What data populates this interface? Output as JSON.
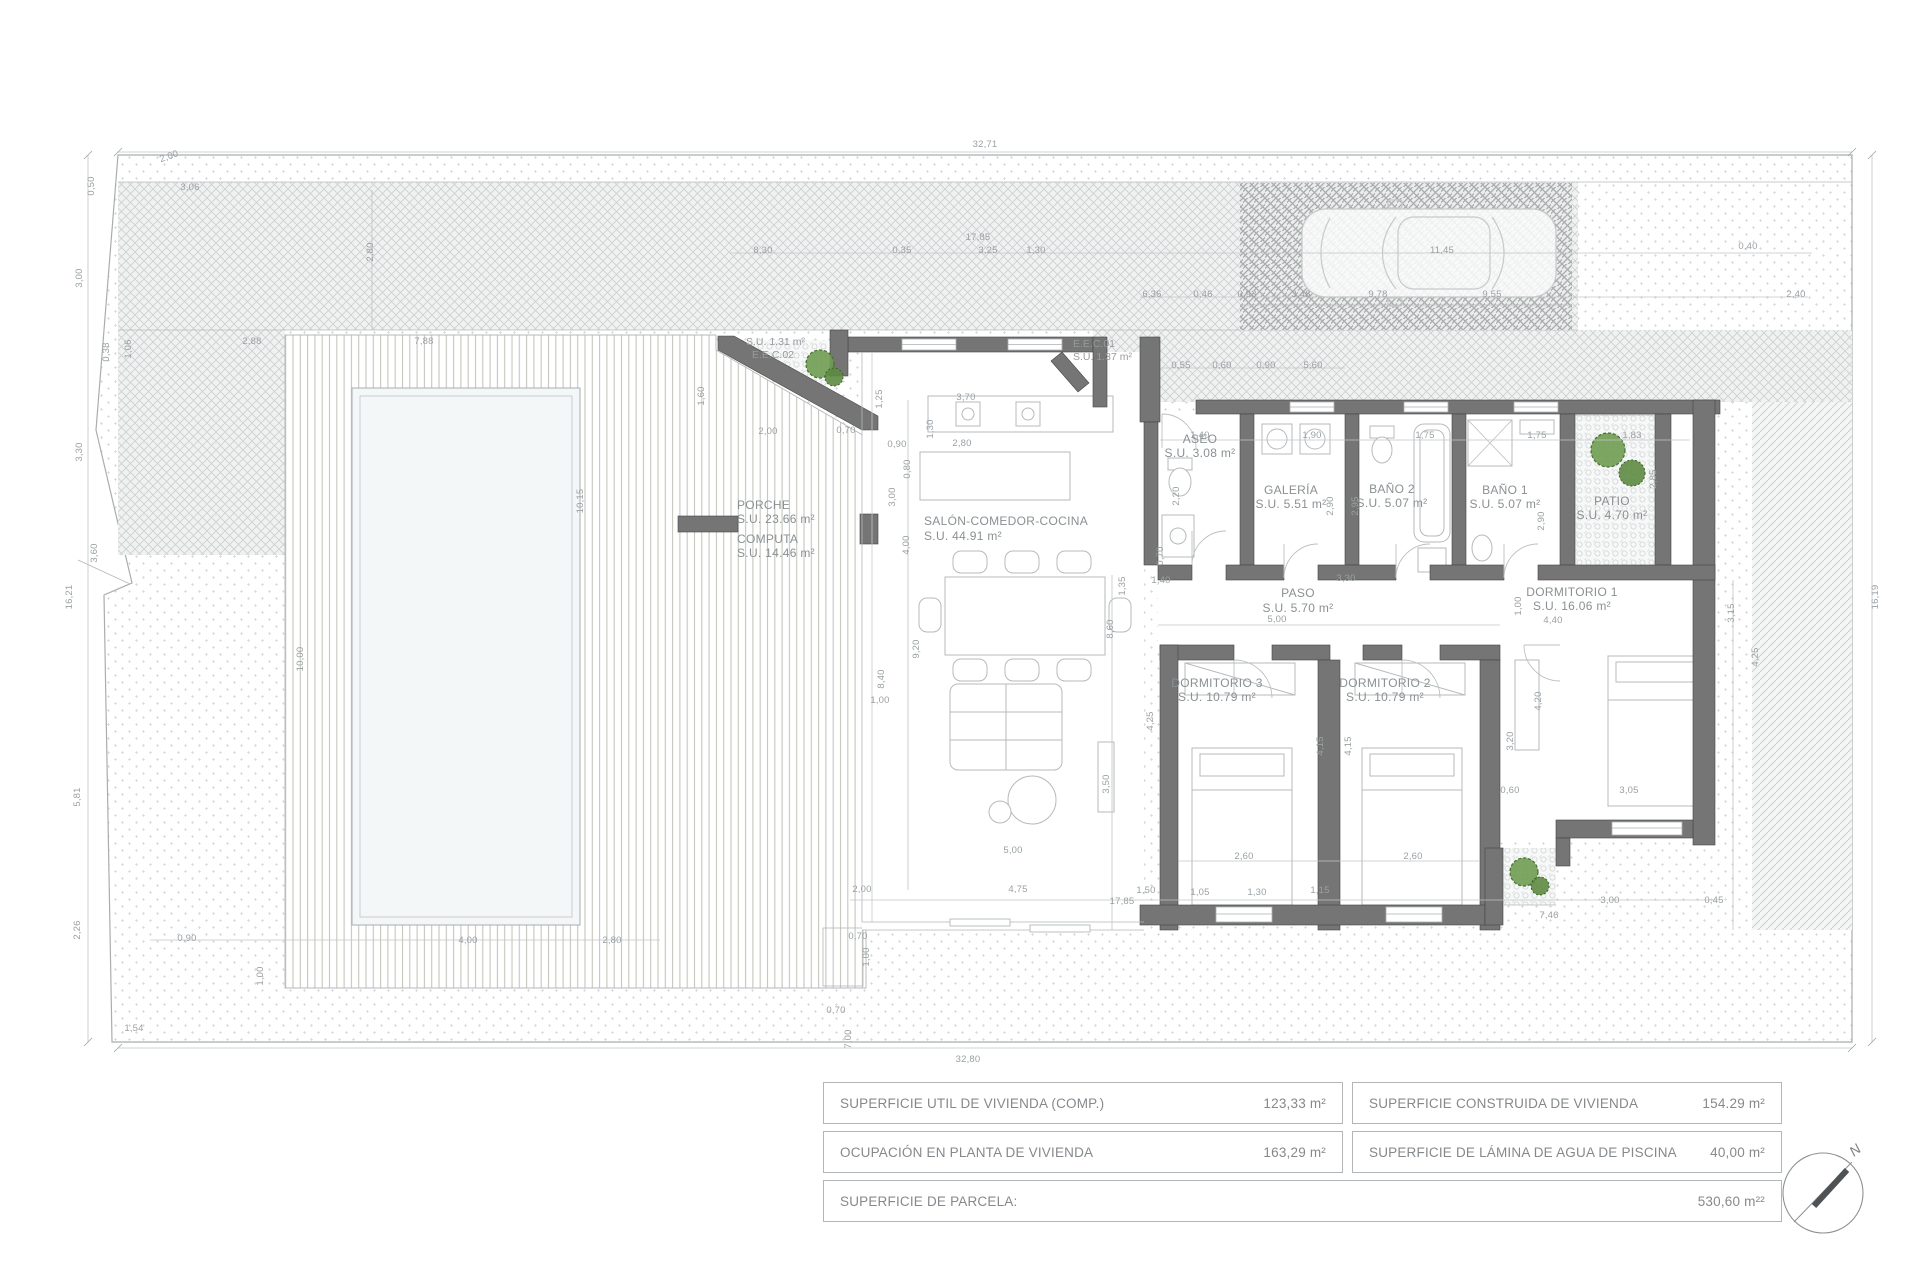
{
  "rooms": {
    "porche": {
      "name": "PORCHE",
      "area": "S.U. 23.66 m²"
    },
    "computa": {
      "name": "COMPUTA",
      "area": "S.U. 14.46 m²"
    },
    "salon": {
      "name": "SALÓN-COMEDOR-COCINA",
      "area": "S.U. 44.91 m²"
    },
    "aseo": {
      "name": "ASEO",
      "area": "S.U. 3.08 m²"
    },
    "galeria": {
      "name": "GALERÍA",
      "area": "S.U. 5.51 m²"
    },
    "bano2": {
      "name": "BAÑO 2",
      "area": "S.U. 5.07 m²"
    },
    "bano1": {
      "name": "BAÑO 1",
      "area": "S.U. 5.07 m²"
    },
    "patio": {
      "name": "PATIO",
      "area": "S.U. 4.70 m²"
    },
    "paso": {
      "name": "PASO",
      "area": "S.U. 5.70 m²"
    },
    "dorm1": {
      "name": "DORMITORIO 1",
      "area": "S.U. 16.06 m²"
    },
    "dorm2": {
      "name": "DORMITORIO 2",
      "area": "S.U. 10.79 m²"
    },
    "dorm3": {
      "name": "DORMITORIO 3",
      "area": "S.U. 10.79 m²"
    },
    "eec01": {
      "name": "E.E.C.01",
      "area": "S.U. 1.37 m²"
    },
    "eec02": {
      "name": "E.E.C.02",
      "area": "S.U. 1.31 m²"
    }
  },
  "summary": {
    "rows": [
      {
        "label": "SUPERFICIE UTIL  DE VIVIENDA (COMP.)",
        "value": "123,33  m²"
      },
      {
        "label": "SUPERFICIE CONSTRUIDA DE VIVIENDA",
        "value": "154.29  m²"
      },
      {
        "label": "OCUPACIÓN EN PLANTA DE VIVIENDA",
        "value": "163,29 m²"
      },
      {
        "label": "SUPERFICIE DE LÁMINA DE AGUA DE PISCINA",
        "value": "40,00  m²"
      },
      {
        "label": "SUPERFICIE DE PARCELA:",
        "value": "530,60 m²²"
      }
    ]
  },
  "compass": {
    "north_label": "N"
  },
  "colors": {
    "wall": "#757575",
    "plant": "#6f9c52",
    "dim_text": "#9aa0a3",
    "label_text": "#8a9092"
  },
  "dimensions": [
    {
      "t": "32,71",
      "x": 985,
      "y": 147,
      "r": 0
    },
    {
      "t": "32,80",
      "x": 968,
      "y": 1062,
      "r": 0
    },
    {
      "t": "16,21",
      "x": 72,
      "y": 597,
      "r": -90
    },
    {
      "t": "16,19",
      "x": 1878,
      "y": 597,
      "r": -90
    },
    {
      "t": "2,00",
      "x": 170,
      "y": 159,
      "r": -20
    },
    {
      "t": "0,50",
      "x": 94,
      "y": 186,
      "r": -90
    },
    {
      "t": "3,00",
      "x": 82,
      "y": 278,
      "r": -90
    },
    {
      "t": "3,30",
      "x": 82,
      "y": 452,
      "r": -90
    },
    {
      "t": "3,60",
      "x": 97,
      "y": 553,
      "r": -90
    },
    {
      "t": "5,81",
      "x": 80,
      "y": 797,
      "r": -90
    },
    {
      "t": "2,26",
      "x": 80,
      "y": 930,
      "r": -90
    },
    {
      "t": "1,54",
      "x": 134,
      "y": 1031,
      "r": 0
    },
    {
      "t": "0,38",
      "x": 109,
      "y": 352,
      "r": -90
    },
    {
      "t": "1,06",
      "x": 131,
      "y": 349,
      "r": -90
    },
    {
      "t": "2,88",
      "x": 252,
      "y": 344,
      "r": 0
    },
    {
      "t": "7,88",
      "x": 424,
      "y": 344,
      "r": 0
    },
    {
      "t": "3,06",
      "x": 190,
      "y": 190,
      "r": 0
    },
    {
      "t": "2,80",
      "x": 373,
      "y": 252,
      "r": -90
    },
    {
      "t": "17,85",
      "x": 978,
      "y": 240,
      "r": 0
    },
    {
      "t": "8,30",
      "x": 763,
      "y": 253,
      "r": 0
    },
    {
      "t": "0,35",
      "x": 902,
      "y": 253,
      "r": 0
    },
    {
      "t": "3,25",
      "x": 988,
      "y": 253,
      "r": 0
    },
    {
      "t": "1,30",
      "x": 1036,
      "y": 253,
      "r": 0
    },
    {
      "t": "11,45",
      "x": 1442,
      "y": 253,
      "r": 0
    },
    {
      "t": "0,40",
      "x": 1748,
      "y": 249,
      "r": 0
    },
    {
      "t": "6,36",
      "x": 1152,
      "y": 297,
      "r": 0
    },
    {
      "t": "0,46",
      "x": 1203,
      "y": 297,
      "r": 0
    },
    {
      "t": "0,93",
      "x": 1247,
      "y": 297,
      "r": 0
    },
    {
      "t": "3,48",
      "x": 1301,
      "y": 297,
      "r": 0
    },
    {
      "t": "9,78",
      "x": 1378,
      "y": 297,
      "r": 0
    },
    {
      "t": "9,55",
      "x": 1492,
      "y": 297,
      "r": 0
    },
    {
      "t": "2,40",
      "x": 1796,
      "y": 297,
      "r": 0
    },
    {
      "t": "0,55",
      "x": 1181,
      "y": 368,
      "r": 0
    },
    {
      "t": "0,60",
      "x": 1222,
      "y": 368,
      "r": 0
    },
    {
      "t": "0,90",
      "x": 1266,
      "y": 368,
      "r": 0
    },
    {
      "t": "5,60",
      "x": 1313,
      "y": 368,
      "r": 0
    },
    {
      "t": "1,60",
      "x": 704,
      "y": 396,
      "r": -90
    },
    {
      "t": "2,00",
      "x": 768,
      "y": 434,
      "r": 0
    },
    {
      "t": "0,70",
      "x": 846,
      "y": 433,
      "r": 0
    },
    {
      "t": "0,90",
      "x": 897,
      "y": 447,
      "r": 0
    },
    {
      "t": "3,70",
      "x": 966,
      "y": 400,
      "r": 0
    },
    {
      "t": "1,25",
      "x": 882,
      "y": 399,
      "r": -90
    },
    {
      "t": "2,80",
      "x": 962,
      "y": 446,
      "r": 0
    },
    {
      "t": "1,30",
      "x": 933,
      "y": 429,
      "r": -90
    },
    {
      "t": "0,80",
      "x": 910,
      "y": 469,
      "r": -90
    },
    {
      "t": "3,00",
      "x": 895,
      "y": 497,
      "r": -90
    },
    {
      "t": "4,00",
      "x": 909,
      "y": 545,
      "r": -90
    },
    {
      "t": "9,20",
      "x": 919,
      "y": 649,
      "r": -90
    },
    {
      "t": "8,40",
      "x": 884,
      "y": 679,
      "r": -90
    },
    {
      "t": "1,00",
      "x": 880,
      "y": 703,
      "r": 0
    },
    {
      "t": "3,50",
      "x": 1109,
      "y": 784,
      "r": -90
    },
    {
      "t": "4,25",
      "x": 1153,
      "y": 721,
      "r": -90
    },
    {
      "t": "5,00",
      "x": 1013,
      "y": 853,
      "r": 0
    },
    {
      "t": "10,15",
      "x": 583,
      "y": 501,
      "r": -90
    },
    {
      "t": "10,00",
      "x": 303,
      "y": 659,
      "r": -90
    },
    {
      "t": "4,00",
      "x": 468,
      "y": 943,
      "r": 0
    },
    {
      "t": "2,80",
      "x": 612,
      "y": 943,
      "r": 0
    },
    {
      "t": "0,90",
      "x": 187,
      "y": 941,
      "r": 0
    },
    {
      "t": "1,00",
      "x": 263,
      "y": 976,
      "r": -90
    },
    {
      "t": "1,40",
      "x": 1200,
      "y": 438,
      "r": 0
    },
    {
      "t": "1,90",
      "x": 1312,
      "y": 438,
      "r": 0
    },
    {
      "t": "1,75",
      "x": 1425,
      "y": 438,
      "r": 0
    },
    {
      "t": "1,75",
      "x": 1537,
      "y": 438,
      "r": 0
    },
    {
      "t": "1,83",
      "x": 1632,
      "y": 438,
      "r": 0
    },
    {
      "t": "2,20",
      "x": 1179,
      "y": 496,
      "r": -90
    },
    {
      "t": "2,90",
      "x": 1333,
      "y": 506,
      "r": -90
    },
    {
      "t": "2,95",
      "x": 1358,
      "y": 506,
      "r": -90
    },
    {
      "t": "2,90",
      "x": 1544,
      "y": 521,
      "r": -90
    },
    {
      "t": "2,85",
      "x": 1656,
      "y": 479,
      "r": -90
    },
    {
      "t": "1,40",
      "x": 1161,
      "y": 583,
      "r": 0
    },
    {
      "t": "3,30",
      "x": 1346,
      "y": 581,
      "r": 0
    },
    {
      "t": "0,70",
      "x": 1163,
      "y": 556,
      "r": -90
    },
    {
      "t": "5,00",
      "x": 1277,
      "y": 622,
      "r": 0
    },
    {
      "t": "1,35",
      "x": 1125,
      "y": 586,
      "r": -90
    },
    {
      "t": "8,60",
      "x": 1113,
      "y": 629,
      "r": -90
    },
    {
      "t": "1,00",
      "x": 1521,
      "y": 606,
      "r": -90
    },
    {
      "t": "4,40",
      "x": 1553,
      "y": 623,
      "r": 0
    },
    {
      "t": "4,20",
      "x": 1541,
      "y": 701,
      "r": -90
    },
    {
      "t": "3,20",
      "x": 1513,
      "y": 741,
      "r": -90
    },
    {
      "t": "4,15",
      "x": 1323,
      "y": 746,
      "r": -90
    },
    {
      "t": "4,15",
      "x": 1351,
      "y": 746,
      "r": -90
    },
    {
      "t": "0,60",
      "x": 1510,
      "y": 793,
      "r": 0
    },
    {
      "t": "3,05",
      "x": 1629,
      "y": 793,
      "r": 0
    },
    {
      "t": "2,60",
      "x": 1244,
      "y": 859,
      "r": 0
    },
    {
      "t": "2,60",
      "x": 1413,
      "y": 859,
      "r": 0
    },
    {
      "t": "2,00",
      "x": 862,
      "y": 892,
      "r": 0
    },
    {
      "t": "4,75",
      "x": 1018,
      "y": 892,
      "r": 0
    },
    {
      "t": "1,50",
      "x": 1146,
      "y": 893,
      "r": 0
    },
    {
      "t": "1,05",
      "x": 1200,
      "y": 895,
      "r": 0
    },
    {
      "t": "1,30",
      "x": 1257,
      "y": 895,
      "r": 0
    },
    {
      "t": "1,15",
      "x": 1320,
      "y": 893,
      "r": 0
    },
    {
      "t": "17,85",
      "x": 1122,
      "y": 904,
      "r": 0
    },
    {
      "t": "3,00",
      "x": 1610,
      "y": 903,
      "r": 0
    },
    {
      "t": "0,45",
      "x": 1714,
      "y": 903,
      "r": 0
    },
    {
      "t": "7,46",
      "x": 1549,
      "y": 918,
      "r": 0
    },
    {
      "t": "0,70",
      "x": 858,
      "y": 939,
      "r": 0
    },
    {
      "t": "1,00",
      "x": 869,
      "y": 957,
      "r": -90
    },
    {
      "t": "0,70",
      "x": 836,
      "y": 1013,
      "r": 0
    },
    {
      "t": "7,00",
      "x": 851,
      "y": 1039,
      "r": -90
    },
    {
      "t": "3,15",
      "x": 1734,
      "y": 613,
      "r": -90
    },
    {
      "t": "4,25",
      "x": 1758,
      "y": 657,
      "r": -90
    }
  ]
}
